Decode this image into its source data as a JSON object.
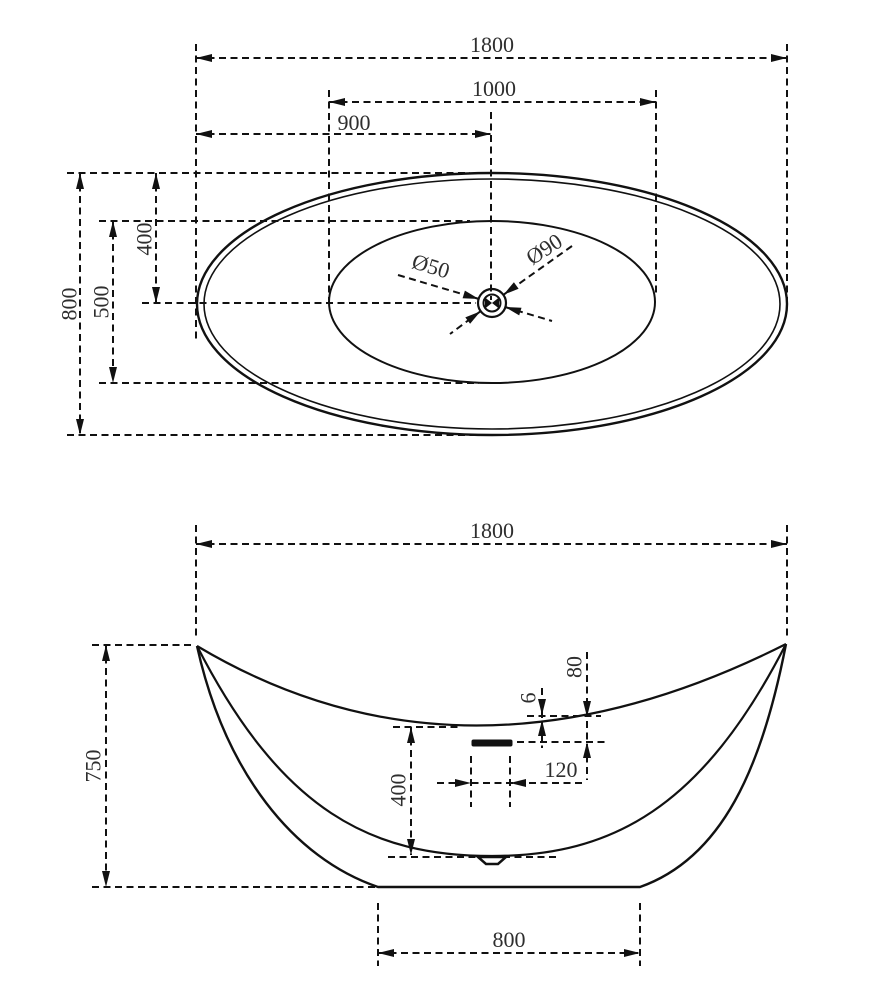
{
  "drawing_title": "Bathtub dimensional drawing",
  "colors": {
    "line": "#111111",
    "text": "#2e2e2e",
    "background": "#ffffff"
  },
  "top_view": {
    "dims": {
      "overall_length": "1800",
      "basin_length": "1000",
      "drain_from_left": "900",
      "overall_width": "800",
      "basin_width": "500",
      "center_offset": "400",
      "drain_hole_diameter": "Ø50",
      "drain_trim_diameter": "Ø90"
    }
  },
  "front_view": {
    "dims": {
      "overall_length": "1800",
      "overall_height": "750",
      "inner_depth": "400",
      "overflow_slot_width": "120",
      "overflow_below_rim": "80",
      "rim_lip": "6",
      "base_length": "800"
    }
  }
}
